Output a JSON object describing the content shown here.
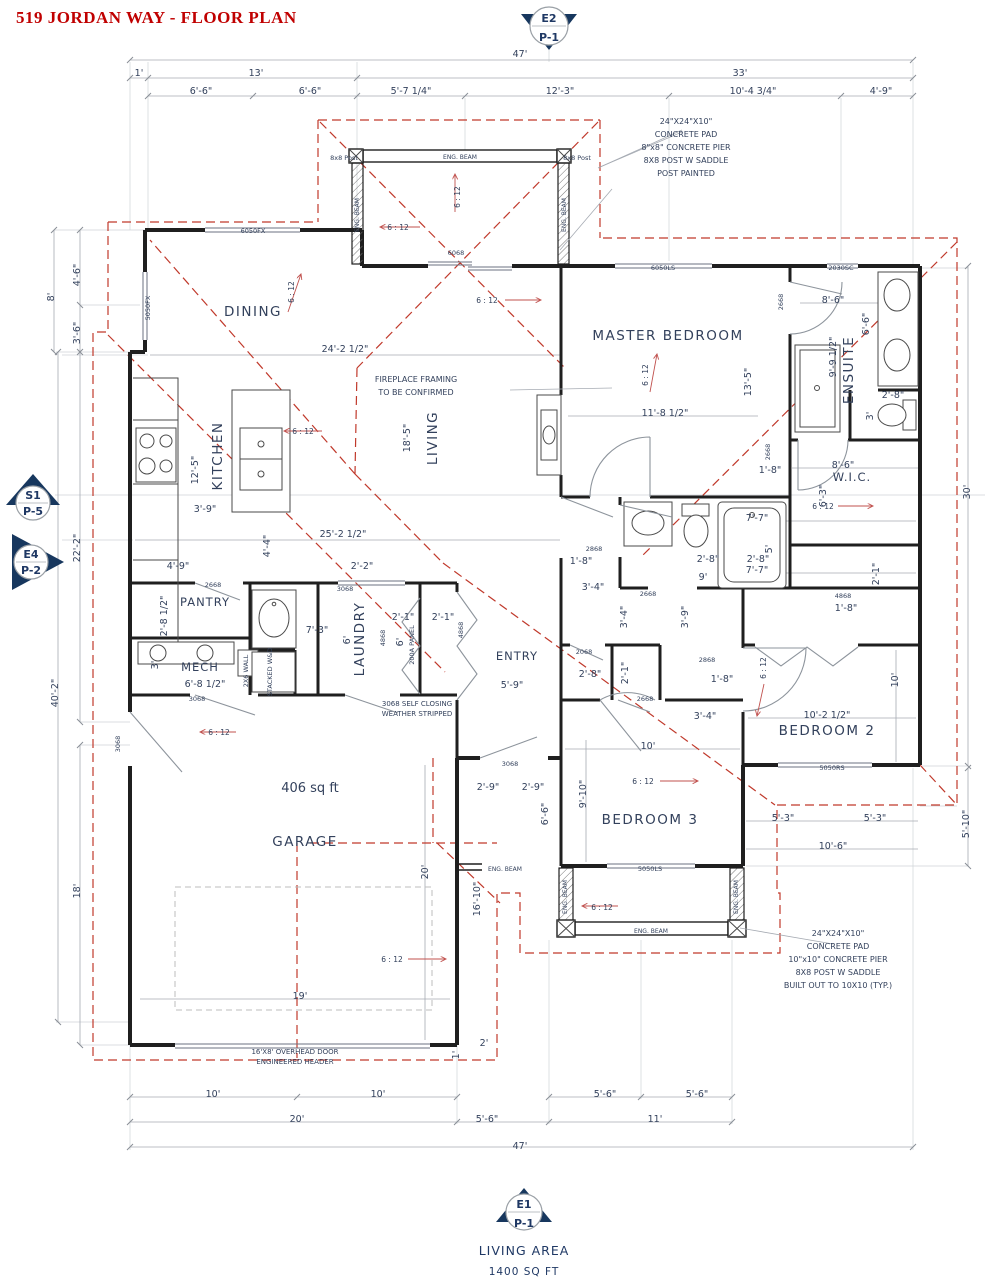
{
  "title": "519 JORDAN WAY - FLOOR PLAN",
  "markers": {
    "e2": {
      "top": "E2",
      "bottom": "P-1"
    },
    "s1": {
      "top": "S1",
      "bottom": "P-5"
    },
    "e4": {
      "top": "E4",
      "bottom": "P-2"
    },
    "e1": {
      "top": "E1",
      "bottom": "P-1"
    }
  },
  "footer": {
    "line1": "LIVING AREA",
    "line2": "1400 SQ FT"
  },
  "labels": [
    {
      "t": "47'",
      "x": 520,
      "y": 57,
      "n": "dim-overall-top"
    },
    {
      "t": "1'",
      "x": 139,
      "y": 76
    },
    {
      "t": "13'",
      "x": 256,
      "y": 76
    },
    {
      "t": "33'",
      "x": 740,
      "y": 76
    },
    {
      "t": "6'-6\"",
      "x": 201,
      "y": 94
    },
    {
      "t": "6'-6\"",
      "x": 310,
      "y": 94
    },
    {
      "t": "5'-7 1/4\"",
      "x": 411,
      "y": 94
    },
    {
      "t": "12'-3\"",
      "x": 560,
      "y": 94
    },
    {
      "t": "10'-4 3/4\"",
      "x": 753,
      "y": 94
    },
    {
      "t": "4'-9\"",
      "x": 881,
      "y": 94
    },
    {
      "t": "24\"X24\"X10\"",
      "x": 686,
      "y": 124,
      "c": "note",
      "n": "note-top-right"
    },
    {
      "t": "CONCRETE PAD",
      "x": 686,
      "y": 137,
      "c": "note",
      "n": "note-top-right"
    },
    {
      "t": "8\"x8\" CONCRETE PIER",
      "x": 686,
      "y": 150,
      "c": "note",
      "n": "note-top-right"
    },
    {
      "t": "8X8 POST W SADDLE",
      "x": 686,
      "y": 163,
      "c": "note",
      "n": "note-top-right"
    },
    {
      "t": "POST PAINTED",
      "x": 686,
      "y": 176,
      "c": "note",
      "n": "note-top-right"
    },
    {
      "t": "24\"X24\"X10\"",
      "x": 838,
      "y": 936,
      "c": "note",
      "n": "note-bottom-right"
    },
    {
      "t": "CONCRETE PAD",
      "x": 838,
      "y": 949,
      "c": "note",
      "n": "note-bottom-right"
    },
    {
      "t": "10\"x10\" CONCRETE PIER",
      "x": 838,
      "y": 962,
      "c": "note",
      "n": "note-bottom-right"
    },
    {
      "t": "8X8 POST W SADDLE",
      "x": 838,
      "y": 975,
      "c": "note",
      "n": "note-bottom-right"
    },
    {
      "t": "BUILT OUT TO 10X10 (TYP.)",
      "x": 838,
      "y": 988,
      "c": "note",
      "n": "note-bottom-right"
    },
    {
      "t": "FIREPLACE FRAMING",
      "x": 416,
      "y": 382,
      "c": "note",
      "n": "note-fireplace"
    },
    {
      "t": "TO BE CONFIRMED",
      "x": 416,
      "y": 395,
      "c": "note",
      "n": "note-fireplace"
    },
    {
      "t": "3068 SELF CLOSING",
      "x": 417,
      "y": 706,
      "c": "note7",
      "n": "note-self-closing"
    },
    {
      "t": "WEATHER STRIPPED",
      "x": 417,
      "y": 716,
      "c": "note7",
      "n": "note-self-closing"
    },
    {
      "t": "16'X8' OVERHEAD DOOR",
      "x": 295,
      "y": 1054,
      "c": "note7",
      "n": "note-overhead-door"
    },
    {
      "t": "ENGINEERED HEADER",
      "x": 295,
      "y": 1064,
      "c": "note7",
      "n": "note-overhead-door"
    },
    {
      "t": "DINING",
      "x": 253,
      "y": 316,
      "c": "room",
      "n": "room-label-dining"
    },
    {
      "t": "KITCHEN",
      "x": 222,
      "y": 456,
      "c": "room",
      "r": -90,
      "n": "room-label-kitchen"
    },
    {
      "t": "LIVING",
      "x": 437,
      "y": 438,
      "c": "room",
      "r": -90,
      "n": "room-label-living"
    },
    {
      "t": "MASTER BEDROOM",
      "x": 668,
      "y": 340,
      "c": "room",
      "n": "room-label-master-bedroom"
    },
    {
      "t": "ENSUITE",
      "x": 853,
      "y": 370,
      "c": "room",
      "r": -90,
      "n": "room-label-ensuite"
    },
    {
      "t": "W.I.C.",
      "x": 852,
      "y": 481,
      "c": "room12",
      "n": "room-label-wic"
    },
    {
      "t": "PANTRY",
      "x": 205,
      "y": 606,
      "c": "room12",
      "n": "room-label-pantry"
    },
    {
      "t": "MECH",
      "x": 200,
      "y": 671,
      "c": "room12",
      "n": "room-label-mech"
    },
    {
      "t": "LAUNDRY",
      "x": 364,
      "y": 639,
      "c": "room",
      "r": -90,
      "n": "room-label-laundry"
    },
    {
      "t": "ENTRY",
      "x": 517,
      "y": 660,
      "c": "room12",
      "n": "room-label-entry"
    },
    {
      "t": "BEDROOM 2",
      "x": 827,
      "y": 735,
      "c": "room",
      "n": "room-label-bedroom-2"
    },
    {
      "t": "BEDROOM 3",
      "x": 650,
      "y": 824,
      "c": "room",
      "n": "room-label-bedroom-3"
    },
    {
      "t": "GARAGE",
      "x": 305,
      "y": 846,
      "c": "room",
      "n": "room-label-garage"
    },
    {
      "t": "406 sq ft",
      "x": 310,
      "y": 792,
      "c": "area",
      "n": "garage-area"
    },
    {
      "t": "4'-6\"",
      "x": 80,
      "y": 275,
      "r": -90
    },
    {
      "t": "8'",
      "x": 54,
      "y": 297,
      "r": -90
    },
    {
      "t": "3'-6\"",
      "x": 80,
      "y": 333,
      "r": -90
    },
    {
      "t": "22'-2\"",
      "x": 80,
      "y": 548,
      "r": -90
    },
    {
      "t": "40'-2\"",
      "x": 58,
      "y": 693,
      "r": -90
    },
    {
      "t": "18'",
      "x": 80,
      "y": 891,
      "r": -90
    },
    {
      "t": "2'-8 1/2\"",
      "x": 167,
      "y": 616,
      "r": -90
    },
    {
      "t": "3'",
      "x": 158,
      "y": 665,
      "r": -90
    },
    {
      "t": "12'-5\"",
      "x": 198,
      "y": 470,
      "r": -90
    },
    {
      "t": "4'-4\"",
      "x": 270,
      "y": 546,
      "r": -90
    },
    {
      "t": "18'-5\"",
      "x": 410,
      "y": 438,
      "r": -90
    },
    {
      "t": "3'-9\"",
      "x": 205,
      "y": 512
    },
    {
      "t": "4'-9\"",
      "x": 178,
      "y": 569
    },
    {
      "t": "24'-2 1/2\"",
      "x": 345,
      "y": 352
    },
    {
      "t": "25'-2 1/2\"",
      "x": 343,
      "y": 537
    },
    {
      "t": "2'-2\"",
      "x": 362,
      "y": 569
    },
    {
      "t": "2'-1\"",
      "x": 403,
      "y": 620
    },
    {
      "t": "2'-1\"",
      "x": 443,
      "y": 620
    },
    {
      "t": "7'-3\"",
      "x": 317,
      "y": 633
    },
    {
      "t": "6'-8 1/2\"",
      "x": 205,
      "y": 687
    },
    {
      "t": "6'",
      "x": 350,
      "y": 640,
      "r": -90
    },
    {
      "t": "6'",
      "x": 403,
      "y": 642,
      "r": -90
    },
    {
      "t": "5'-9\"",
      "x": 512,
      "y": 688
    },
    {
      "t": "2'-8\"",
      "x": 590,
      "y": 677
    },
    {
      "t": "2'-1\"",
      "x": 628,
      "y": 673,
      "r": -90
    },
    {
      "t": "2'-9\"",
      "x": 488,
      "y": 790
    },
    {
      "t": "2'-9\"",
      "x": 533,
      "y": 790
    },
    {
      "t": "9'-10\"",
      "x": 586,
      "y": 794,
      "r": -90
    },
    {
      "t": "6'-6\"",
      "x": 548,
      "y": 814,
      "r": -90
    },
    {
      "t": "10'",
      "x": 648,
      "y": 749
    },
    {
      "t": "19'",
      "x": 300,
      "y": 999
    },
    {
      "t": "20'",
      "x": 428,
      "y": 872,
      "r": -90
    },
    {
      "t": "16'-10\"",
      "x": 480,
      "y": 899,
      "r": -90
    },
    {
      "t": "2'",
      "x": 484,
      "y": 1046
    },
    {
      "t": "1'",
      "x": 459,
      "y": 1055,
      "r": -90
    },
    {
      "t": "10'",
      "x": 213,
      "y": 1097
    },
    {
      "t": "10'",
      "x": 378,
      "y": 1097
    },
    {
      "t": "20'",
      "x": 297,
      "y": 1122
    },
    {
      "t": "5'-6\"",
      "x": 487,
      "y": 1122
    },
    {
      "t": "5'-6\"",
      "x": 605,
      "y": 1097
    },
    {
      "t": "5'-6\"",
      "x": 697,
      "y": 1097
    },
    {
      "t": "11'",
      "x": 655,
      "y": 1122
    },
    {
      "t": "47'",
      "x": 520,
      "y": 1149,
      "n": "dim-overall-bottom"
    },
    {
      "t": "11'-8 1/2\"",
      "x": 665,
      "y": 416
    },
    {
      "t": "13'-5\"",
      "x": 751,
      "y": 382,
      "r": -90
    },
    {
      "t": "9'-9 1/2\"",
      "x": 836,
      "y": 357,
      "r": -90
    },
    {
      "t": "8'-6\"",
      "x": 833,
      "y": 303
    },
    {
      "t": "6'-6\"",
      "x": 869,
      "y": 324,
      "r": -90
    },
    {
      "t": "2'-8\"",
      "x": 893,
      "y": 398
    },
    {
      "t": "3'",
      "x": 873,
      "y": 416,
      "r": -90
    },
    {
      "t": "8'-6\"",
      "x": 843,
      "y": 468
    },
    {
      "t": "6'-3\"",
      "x": 826,
      "y": 496,
      "r": -90
    },
    {
      "t": "1'-8\"",
      "x": 770,
      "y": 473
    },
    {
      "t": "7'-7\"",
      "x": 757,
      "y": 521
    },
    {
      "t": "30'",
      "x": 970,
      "y": 492,
      "r": -90
    },
    {
      "t": "7'-7\"",
      "x": 757,
      "y": 573
    },
    {
      "t": "2'-1\"",
      "x": 879,
      "y": 574,
      "r": -90
    },
    {
      "t": "10'",
      "x": 898,
      "y": 680,
      "r": -90
    },
    {
      "t": "10'-2 1/2\"",
      "x": 827,
      "y": 718
    },
    {
      "t": "5'-3\"",
      "x": 783,
      "y": 821
    },
    {
      "t": "5'-3\"",
      "x": 875,
      "y": 821
    },
    {
      "t": "10'-6\"",
      "x": 833,
      "y": 849
    },
    {
      "t": "5'-10\"",
      "x": 969,
      "y": 824,
      "r": -90
    },
    {
      "t": "1'-8\"",
      "x": 581,
      "y": 564
    },
    {
      "t": "3'-4\"",
      "x": 593,
      "y": 590
    },
    {
      "t": "3'-4\"",
      "x": 627,
      "y": 617,
      "r": -90
    },
    {
      "t": "3'-9\"",
      "x": 688,
      "y": 617,
      "r": -90
    },
    {
      "t": "2'-8\"",
      "x": 708,
      "y": 562
    },
    {
      "t": "2'-8\"",
      "x": 758,
      "y": 562
    },
    {
      "t": "9'",
      "x": 703,
      "y": 580
    },
    {
      "t": "5'",
      "x": 772,
      "y": 549,
      "r": -90
    },
    {
      "t": "1'-8\"",
      "x": 722,
      "y": 682
    },
    {
      "t": "3'-4\"",
      "x": 705,
      "y": 719
    },
    {
      "t": "1'-8\"",
      "x": 846,
      "y": 611
    },
    {
      "t": "6050FX",
      "x": 253,
      "y": 233,
      "c": "tiny",
      "n": "window-size"
    },
    {
      "t": "5050FX",
      "x": 150,
      "y": 308,
      "c": "tiny",
      "r": -90,
      "n": "window-size"
    },
    {
      "t": "6050LS",
      "x": 663,
      "y": 270,
      "c": "tiny",
      "n": "window-size"
    },
    {
      "t": "2030SC",
      "x": 841,
      "y": 270,
      "c": "tiny",
      "n": "window-size"
    },
    {
      "t": "6068",
      "x": 456,
      "y": 255,
      "c": "tiny",
      "n": "door-size"
    },
    {
      "t": "2668",
      "x": 213,
      "y": 587,
      "c": "tiny",
      "n": "door-size"
    },
    {
      "t": "3068",
      "x": 197,
      "y": 701,
      "c": "tiny",
      "n": "door-size"
    },
    {
      "t": "3068",
      "x": 345,
      "y": 591,
      "c": "tiny",
      "n": "door-size"
    },
    {
      "t": "2068",
      "x": 584,
      "y": 654,
      "c": "tiny",
      "n": "door-size"
    },
    {
      "t": "2668",
      "x": 645,
      "y": 701,
      "c": "tiny",
      "n": "door-size"
    },
    {
      "t": "3068",
      "x": 510,
      "y": 766,
      "c": "tiny",
      "n": "door-size"
    },
    {
      "t": "2868",
      "x": 594,
      "y": 551,
      "c": "tiny",
      "n": "door-size"
    },
    {
      "t": "2668",
      "x": 648,
      "y": 596,
      "c": "tiny",
      "n": "door-size"
    },
    {
      "t": "2868",
      "x": 707,
      "y": 662,
      "c": "tiny",
      "n": "door-size"
    },
    {
      "t": "2668",
      "x": 783,
      "y": 302,
      "c": "tiny",
      "r": -90,
      "n": "door-size"
    },
    {
      "t": "2668",
      "x": 770,
      "y": 452,
      "c": "tiny",
      "r": -90,
      "n": "door-size"
    },
    {
      "t": "4868",
      "x": 843,
      "y": 598,
      "c": "tiny",
      "n": "door-size"
    },
    {
      "t": "4868",
      "x": 463,
      "y": 630,
      "c": "tiny",
      "r": -90,
      "n": "door-size"
    },
    {
      "t": "4868",
      "x": 385,
      "y": 638,
      "c": "tiny",
      "r": -90,
      "n": "door-size"
    },
    {
      "t": "5050LS",
      "x": 650,
      "y": 871,
      "c": "tiny",
      "n": "window-size"
    },
    {
      "t": "5050RS",
      "x": 832,
      "y": 770,
      "c": "tiny",
      "n": "window-size"
    },
    {
      "t": "3068",
      "x": 120,
      "y": 744,
      "c": "tiny",
      "r": -90,
      "n": "door-size"
    },
    {
      "t": "200A PANEL",
      "x": 414,
      "y": 645,
      "c": "tiny",
      "r": -90,
      "n": "panel-note"
    },
    {
      "t": "2X6 WALL",
      "x": 248,
      "y": 671,
      "c": "tiny",
      "r": -90,
      "n": "wall-note"
    },
    {
      "t": "STACKED W&D",
      "x": 272,
      "y": 672,
      "c": "tiny",
      "r": -90,
      "n": "appliance-note"
    },
    {
      "t": "8x8 Post",
      "x": 344,
      "y": 160,
      "c": "tiny",
      "a": "end",
      "n": "post-note"
    },
    {
      "t": "8x8 Post",
      "x": 577,
      "y": 160,
      "c": "tiny",
      "a": "start",
      "n": "post-note"
    },
    {
      "t": "ENG. BEAM",
      "x": 460,
      "y": 159,
      "c": "eng",
      "n": "beam-label"
    },
    {
      "t": "ENG. BEAM",
      "x": 359,
      "y": 215,
      "c": "eng",
      "r": -90,
      "n": "beam-label"
    },
    {
      "t": "ENG. BEAM",
      "x": 566,
      "y": 215,
      "c": "eng",
      "r": -90,
      "n": "beam-label"
    },
    {
      "t": "ENG. BEAM",
      "x": 567,
      "y": 897,
      "c": "eng",
      "r": -90,
      "n": "beam-label"
    },
    {
      "t": "ENG. BEAM",
      "x": 738,
      "y": 897,
      "c": "eng",
      "r": -90,
      "n": "beam-label"
    },
    {
      "t": "ENG. BEAM",
      "x": 651,
      "y": 933,
      "c": "eng",
      "n": "beam-label"
    },
    {
      "t": "ENG. BEAM",
      "x": 505,
      "y": 871,
      "c": "eng",
      "n": "beam-label"
    },
    {
      "t": "6 : 12",
      "x": 398,
      "y": 230,
      "c": "red",
      "n": "slope-label"
    },
    {
      "t": "6 : 12",
      "x": 460,
      "y": 197,
      "c": "red",
      "r": -90,
      "n": "slope-label"
    },
    {
      "t": "6 : 12",
      "x": 294,
      "y": 292,
      "c": "red",
      "r": -90,
      "n": "slope-label"
    },
    {
      "t": "6 : 12",
      "x": 487,
      "y": 303,
      "c": "red",
      "n": "slope-label"
    },
    {
      "t": "6 : 12",
      "x": 648,
      "y": 375,
      "c": "red",
      "r": -90,
      "n": "slope-label"
    },
    {
      "t": "6 : 12",
      "x": 303,
      "y": 434,
      "c": "red",
      "n": "slope-label"
    },
    {
      "t": "6 : 12",
      "x": 823,
      "y": 509,
      "c": "red",
      "n": "slope-label"
    },
    {
      "t": "6 : 12",
      "x": 219,
      "y": 735,
      "c": "red",
      "n": "slope-label"
    },
    {
      "t": "6 : 12",
      "x": 643,
      "y": 784,
      "c": "red",
      "n": "slope-label"
    },
    {
      "t": "6 : 12",
      "x": 392,
      "y": 962,
      "c": "red",
      "n": "slope-label"
    },
    {
      "t": "6 : 12",
      "x": 602,
      "y": 910,
      "c": "red",
      "n": "slope-label"
    },
    {
      "t": "6 : 12",
      "x": 766,
      "y": 668,
      "c": "red",
      "r": -90,
      "n": "slope-label"
    }
  ]
}
